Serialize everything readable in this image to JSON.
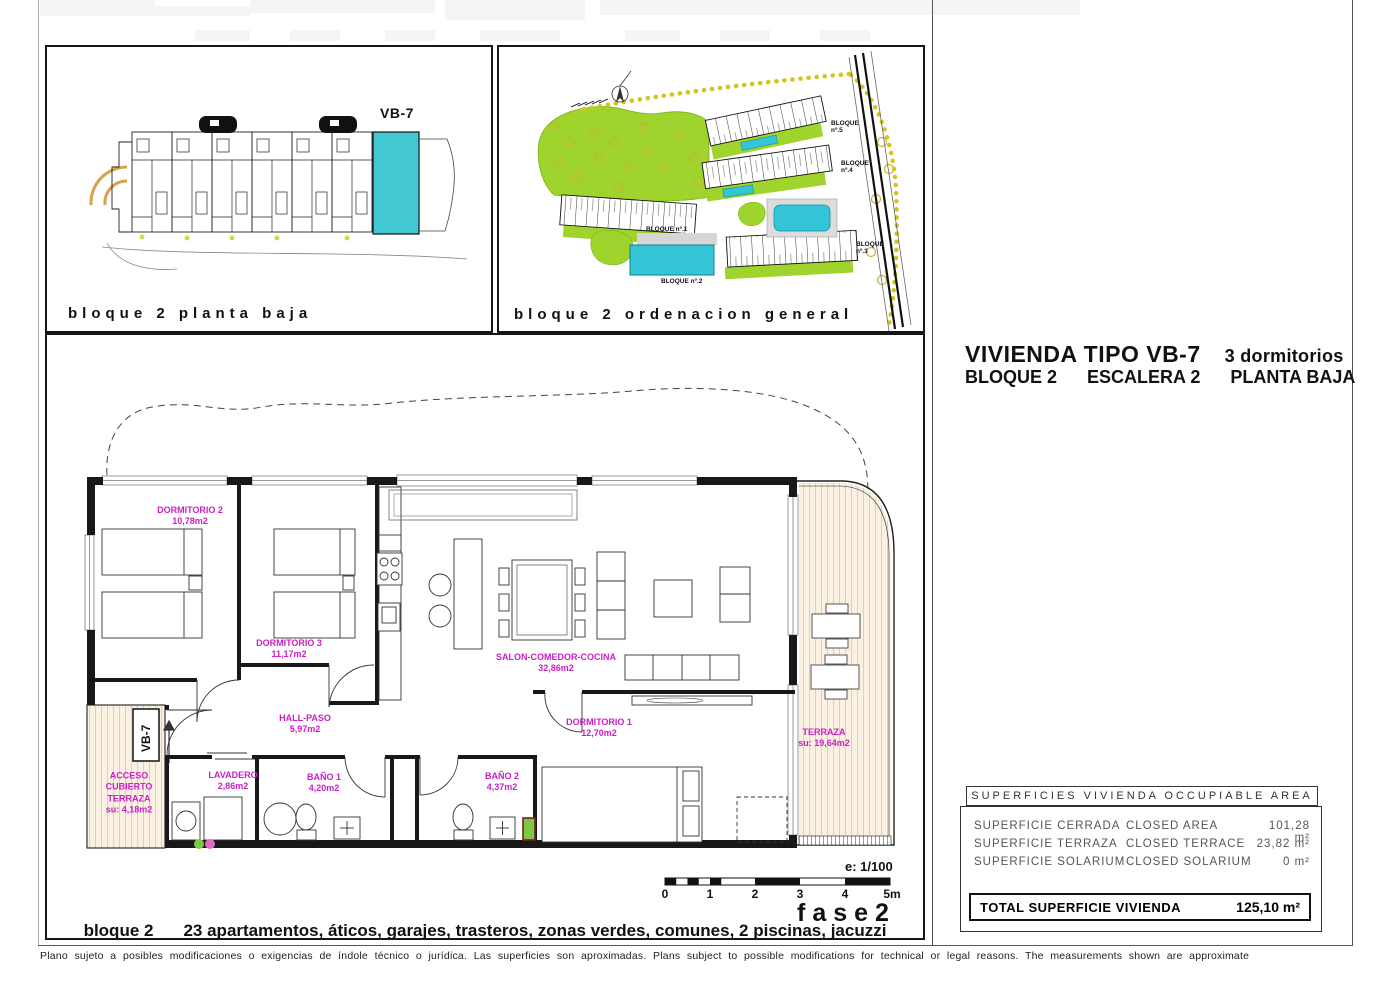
{
  "colors": {
    "highlight_cyan": "#41c8d2",
    "pool_cyan": "#35c5d8",
    "label_magenta": "#ca1fc5",
    "garden_green": "#9ed42c",
    "terrace_tan": "#d8ab70"
  },
  "top_left_panel": {
    "caption": "bloque 2 planta baja",
    "unit_label": "VB-7"
  },
  "site_panel": {
    "caption": "bloque 2 ordenacion general",
    "blocks": [
      {
        "label": "BLOQUE nº.1"
      },
      {
        "label": "BLOQUE nº.2"
      },
      {
        "label": "BLOQUE nº.3"
      },
      {
        "label": "BLOQUE nº.4"
      },
      {
        "label": "BLOQUE nº.5"
      }
    ]
  },
  "title_block": {
    "title": "VIVIENDA TIPO VB-7",
    "subtitle": "3 dormitorios",
    "line2": [
      "BLOQUE 2",
      "ESCALERA 2",
      "PLANTA BAJA"
    ]
  },
  "floor_plan": {
    "unit_tag": "VB-7",
    "rooms": [
      {
        "name": "DORMITORIO 2",
        "area": "10,78m2"
      },
      {
        "name": "DORMITORIO 3",
        "area": "11,17m2"
      },
      {
        "name": "SALON-COMEDOR-COCINA",
        "area": "32,86m2"
      },
      {
        "name": "HALL-PASO",
        "area": "5,97m2"
      },
      {
        "name": "LAVADERO",
        "area": "2,86m2"
      },
      {
        "name": "BAÑO 1",
        "area": "4,20m2"
      },
      {
        "name": "BAÑO 2",
        "area": "4,37m2"
      },
      {
        "name": "DORMITORIO 1",
        "area": "12,70m2"
      },
      {
        "name": "TERRAZA",
        "area": "su: 19,64m2"
      },
      {
        "name": "ACCESO CUBIERTO TERRAZA",
        "area": "su: 4,18m2"
      }
    ],
    "scale_label": "e: 1/100",
    "scale_ticks": [
      "0",
      "1",
      "2",
      "3",
      "4",
      "5m"
    ],
    "phase": "fase2",
    "caption_prefix": "bloque 2",
    "caption": "23 apartamentos, áticos, garajes, trasteros, zonas verdes, comunes, 2 piscinas, jacuzzi"
  },
  "surface_table": {
    "header": "SUPERFICIES VIVIENDA OCCUPIABLE AREA",
    "rows": [
      {
        "es": "SUPERFICIE CERRADA",
        "en": "CLOSED AREA",
        "value": "101,28 m²"
      },
      {
        "es": "SUPERFICIE TERRAZA",
        "en": "CLOSED TERRACE",
        "value": "23,82 m²"
      },
      {
        "es": "SUPERFICIE SOLARIUM",
        "en": "CLOSED SOLARIUM",
        "value": "0 m²"
      }
    ],
    "total": {
      "label": "TOTAL SUPERFICIE VIVIENDA",
      "value": "125,10 m²"
    }
  },
  "disclaimer": "Plano sujeto a posibles modificaciones o exigencias de índole técnico o jurídica. Las superficies son aproximadas. Plans subject to possible modifications for technical or legal reasons. The measurements shown are approximate"
}
